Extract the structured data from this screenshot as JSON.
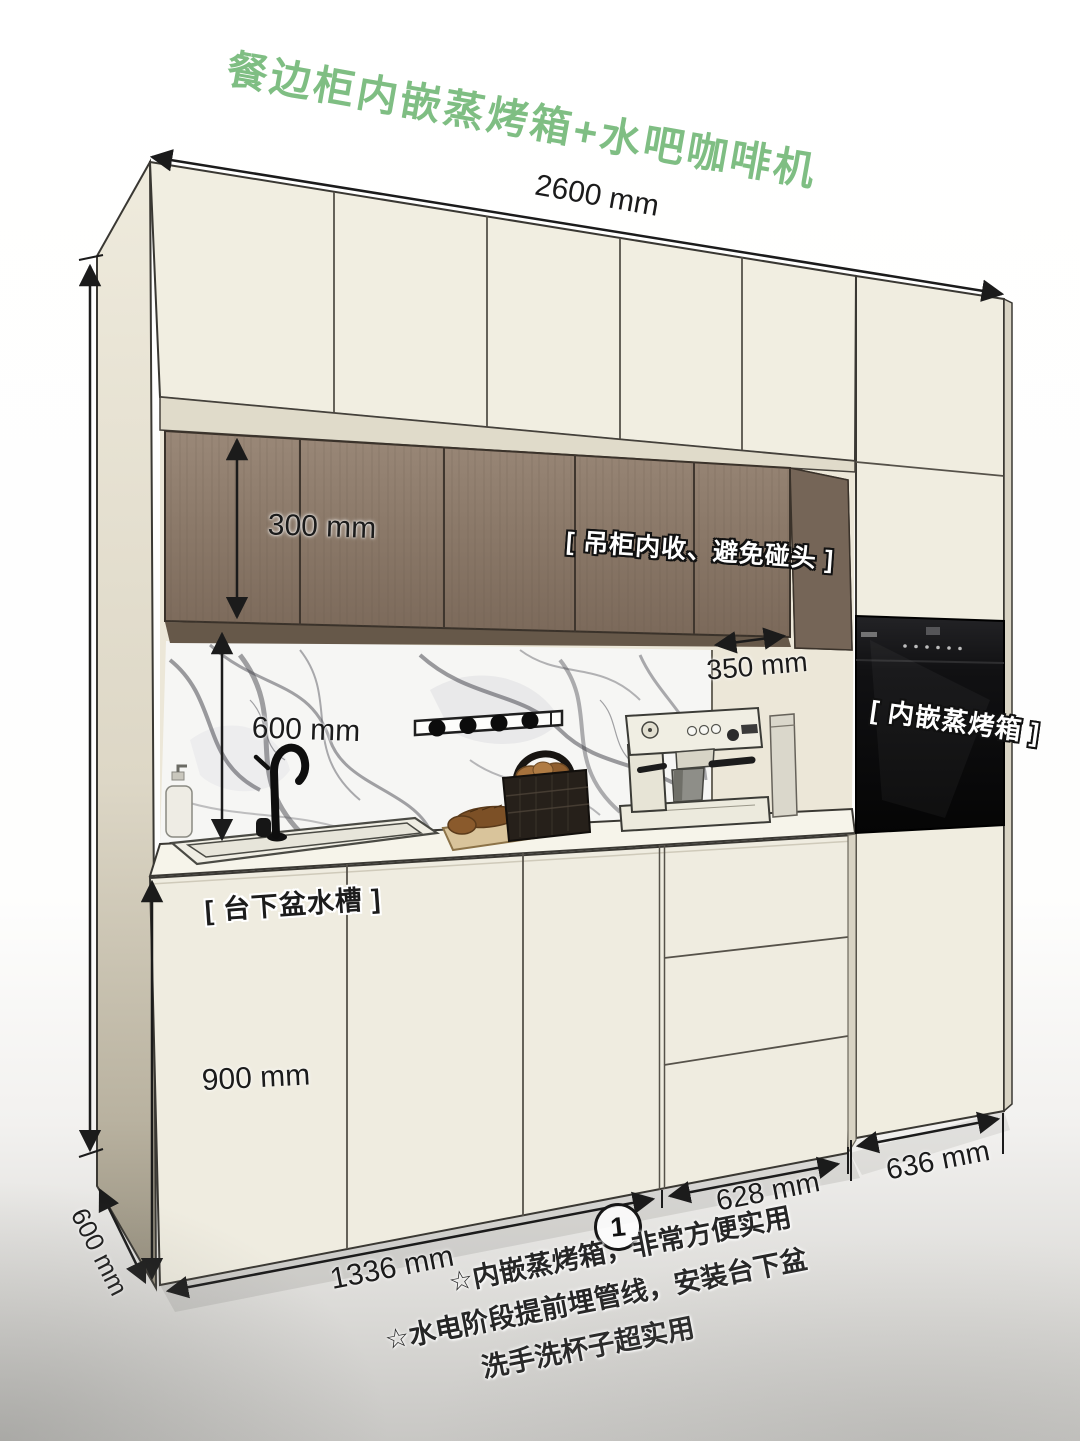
{
  "title": "餐边柜内嵌蒸烤箱+水吧咖啡机",
  "dimensions": {
    "total_width": "2600 mm",
    "upper_cabinet_height": "300 mm",
    "upper_cabinet_setback": "350 mm",
    "backsplash_height": "600 mm",
    "base_cabinet_height": "900 mm",
    "cabinet_depth": "600 mm",
    "left_section_width": "1336 mm",
    "middle_section_width": "628 mm",
    "right_section_width": "636 mm"
  },
  "callouts": {
    "upper_cabinet": "[ 吊柜内收、避免碰头 ]",
    "steam_oven": "[ 内嵌蒸烤箱 ]",
    "sink": "[ 台下盆水槽 ]"
  },
  "footnote_marker": "1",
  "notes": [
    "☆内嵌蒸烤箱，非常方便实用",
    "☆水电阶段提前埋管线，安装台下盆",
    "洗手洗杯子超实用"
  ],
  "colors": {
    "title_green": "#7fbe83",
    "cabinet_cream": "#f1eee1",
    "wood_brown": "#8a7a6c",
    "oven_black": "#101010",
    "marble_white": "#f6f6f4",
    "line_ink": "#3a3833"
  }
}
